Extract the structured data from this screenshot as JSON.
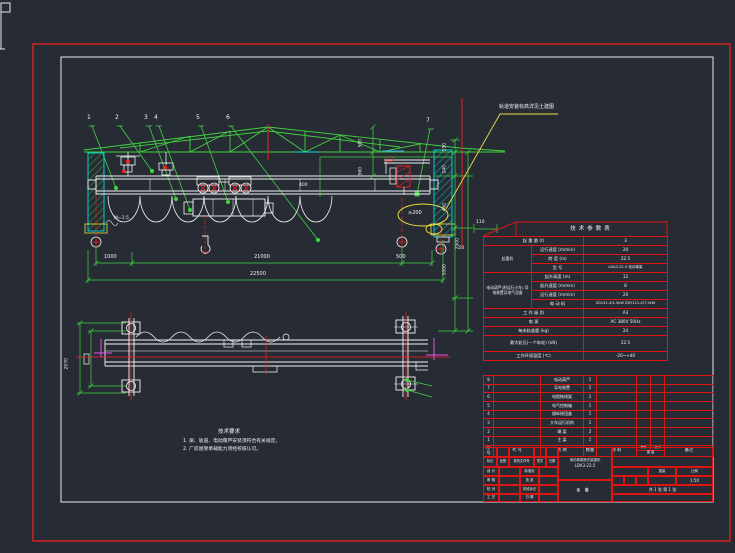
{
  "colors": {
    "background": "#272c34",
    "line_white": "#f2f2f2",
    "cad_green": "#41d141",
    "cad_red": "#fa1e1e",
    "cad_cyan": "#00dcdc",
    "cad_yellow": "#f0e03c",
    "cad_magenta": "#e94fe9",
    "table_red": "#e01414"
  },
  "drawing": {
    "annotation_elevation": "轨道安装标高详见土建图",
    "callouts": [
      "1",
      "2",
      "3",
      "4",
      "5",
      "6",
      "7"
    ],
    "front_dims": {
      "seg1": "1000",
      "seg2": "21000",
      "seg3": "500",
      "overall": "22500",
      "rail_note": "M=1:5",
      "mid": "400",
      "clearance": "≥200",
      "d110": "110",
      "d50": "50",
      "v_a": "500",
      "v_b": "560",
      "v_c": "150",
      "v_d": "240",
      "v_e": "400",
      "v_f": "1000",
      "v_g": "2500"
    },
    "plan_dims": {
      "v_h": "2070"
    },
    "notes": {
      "title": "技术要求",
      "line1": "1. 梁、轨道、电动葫芦安装须符合有关规定。",
      "line2": "2. 厂房屋架承载能力须经校核认可。"
    }
  },
  "param_table": {
    "title": "技术参数表",
    "rows": [
      {
        "label": "起 重 量 (t)",
        "value": "3"
      },
      {
        "group": "起重机",
        "label": "运行速度 (m/min)",
        "value": "20"
      },
      {
        "label": "跨 度 (m)",
        "value": "22.5"
      },
      {
        "label": "型 号",
        "value": "LDA3-22.5 电动单梁"
      },
      {
        "group": "电动葫芦(附运行小车) 导电装置及电气设备",
        "label": "起升高度 (m)",
        "value": "12"
      },
      {
        "label": "起升速度 (m/min)",
        "value": "8"
      },
      {
        "label": "运行速度 (m/min)",
        "value": "20"
      },
      {
        "label": "电 动 机",
        "value": "ZD141-4/1.5kW ZDY121-4/7.5kW"
      },
      {
        "label": "工 作 级 别",
        "value": "A3"
      },
      {
        "label": "电 源",
        "value": "AC 380V 50Hz"
      },
      {
        "label": "每米轨道重 (kg)",
        "value": "24"
      },
      {
        "label": "最大轮压(一个车轮) (kN)",
        "value": "22.5"
      },
      {
        "label": "工作环境温度 (℃)",
        "value": "-20~+40"
      }
    ]
  },
  "bom": {
    "headers": {
      "no": "序号",
      "code": "代 号",
      "name": "名 称",
      "qty": "数量",
      "material": "材 料",
      "unit": "单件",
      "total": "总计",
      "weight": "重 量",
      "remark": "备注"
    },
    "rows": [
      {
        "no": "8",
        "name": "电动葫芦",
        "qty": "1"
      },
      {
        "no": "7",
        "name": "导电装置",
        "qty": "1"
      },
      {
        "no": "6",
        "name": "电缆拖线架",
        "qty": "1"
      },
      {
        "no": "5",
        "name": "电气控制箱",
        "qty": "1"
      },
      {
        "no": "4",
        "name": "操纵按钮盒",
        "qty": "1"
      },
      {
        "no": "3",
        "name": "大车运行机构",
        "qty": "1"
      },
      {
        "no": "2",
        "name": "端 梁",
        "qty": "2"
      },
      {
        "no": "1",
        "name": "主 梁",
        "qty": "1"
      }
    ]
  },
  "title_block": {
    "rev_labels": [
      "标记",
      "处数",
      "更改文件号",
      "签字",
      "日期"
    ],
    "sig_rows": [
      [
        "设 计",
        "标准化"
      ],
      [
        "审 核",
        "批 准"
      ],
      [
        "校 对",
        "阶段标记"
      ],
      [
        "工 艺",
        "日 期"
      ]
    ],
    "title_line1": "电动单梁桥式起重机",
    "title_line2": "LDA3-22.5",
    "drawing_name": "总图",
    "weight_label": "重量",
    "scale_label": "比例",
    "scale_value": "1:50",
    "sheet_info": "共 1 张 第 1 张"
  }
}
